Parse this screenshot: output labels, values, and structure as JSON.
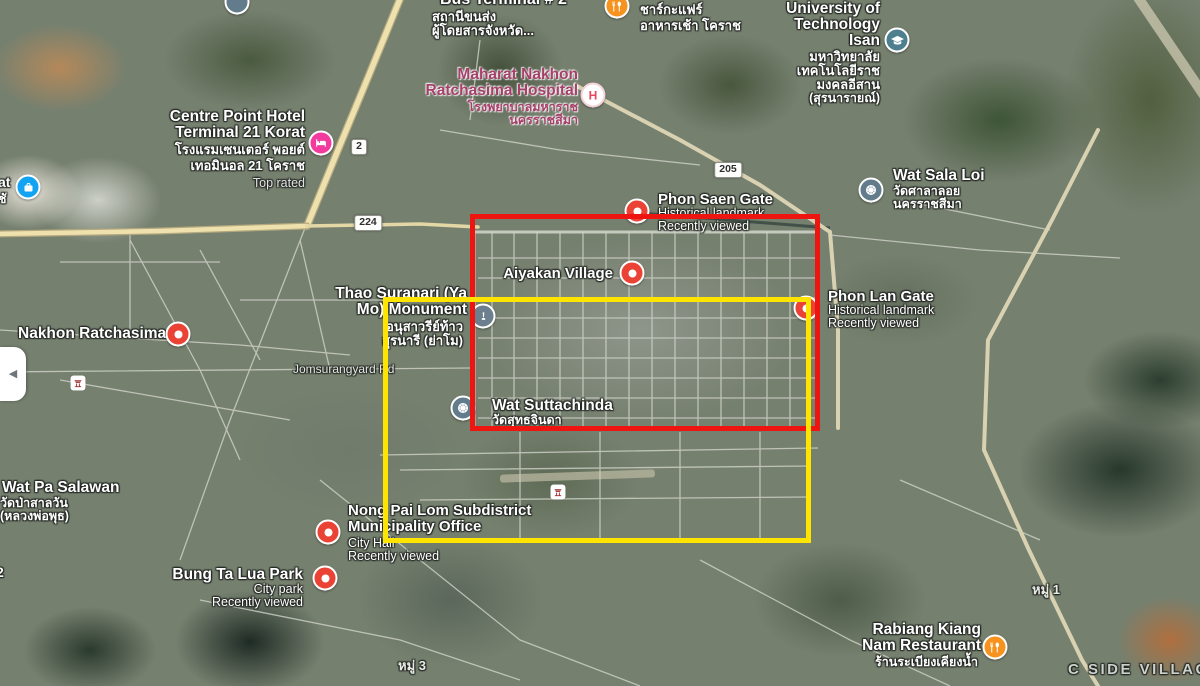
{
  "ui": {
    "panel_toggle_arrow": "◀"
  },
  "annotations": {
    "red_box_color": "#ee1511",
    "yellow_box_color": "#ffe400"
  },
  "shields": {
    "s2": "2",
    "s224": "224",
    "s205": "205"
  },
  "labels": {
    "jomsurangyard": "Jomsurangyard Rd",
    "moo3": "หมู่ 3",
    "moo1": "หมู่ 1",
    "cside": "C SIDE VILLAGE",
    "frag_at": "at",
    "frag_thai": "ชั",
    "frag_2": "2"
  },
  "places": {
    "bus_terminal": {
      "name": "Bus Terminal # 2",
      "thai1": "สถานีขนส่ง",
      "thai2": "ผู้โดยสารจังหวัด..."
    },
    "chakafare": {
      "thai1": "ชาร์กะแฟร์",
      "thai2": "อาหารเช้า โคราช"
    },
    "university": {
      "l1": "University of",
      "l2": "Technology",
      "l3": "Isan",
      "thai1": "มหาวิทยาลัย",
      "thai2": "เทคโนโลยีราช",
      "thai3": "มงคลอีสาน",
      "thai4": "(สุรนารายณ์)"
    },
    "maharat": {
      "l1": "Maharat Nakhon",
      "l2": "Ratchasima Hospital",
      "thai1": "โรงพยาบาลมหาราช",
      "thai2": "นครราชสีมา",
      "marker_letter": "H"
    },
    "centre_point": {
      "l1": "Centre Point Hotel",
      "l2": "Terminal 21 Korat",
      "thai1": "โรงแรมเซนเตอร์ พอยต์",
      "thai2": "เทอมินอล 21 โคราช",
      "badge": "Top rated"
    },
    "wat_sala_loi": {
      "name": "Wat Sala Loi",
      "thai1": "วัดศาลาลอย",
      "thai2": "นครราชสีมา"
    },
    "phon_saen": {
      "name": "Phon Saen Gate",
      "type": "Historical landmark",
      "status": "Recently viewed"
    },
    "aiyakan": {
      "name": "Aiyakan Village"
    },
    "phon_lan": {
      "name": "Phon Lan Gate",
      "type": "Historical landmark",
      "status": "Recently viewed"
    },
    "thao_suranari": {
      "l1": "Thao Suranari (Ya",
      "l2": "Mo) Monument",
      "thai1": "อนุสาวรีย์ท้าว",
      "thai2": "สุรนารี (ย่าโม)"
    },
    "nakhon_ratchasima": {
      "name": "Nakhon Ratchasima"
    },
    "wat_suttachinda": {
      "name": "Wat Suttachinda",
      "thai1": "วัดสุทธจินดา"
    },
    "wat_pa_salawan": {
      "name": "Wat Pa Salawan",
      "thai1": "วัดป่าสาลวัน",
      "thai2": "(หลวงพ่อพุธ)"
    },
    "nong_pai_lom": {
      "l1": "Nong Pai Lom Subdistrict",
      "l2": "Municipality Office",
      "type": "City Hall",
      "status": "Recently viewed"
    },
    "bung_ta_lua": {
      "name": "Bung Ta Lua Park",
      "type": "City park",
      "status": "Recently viewed"
    },
    "rabiang": {
      "l1": "Rabiang Kiang",
      "l2": "Nam Restaurant",
      "thai1": "ร้านระเบียงเคียงน้ำ"
    }
  }
}
